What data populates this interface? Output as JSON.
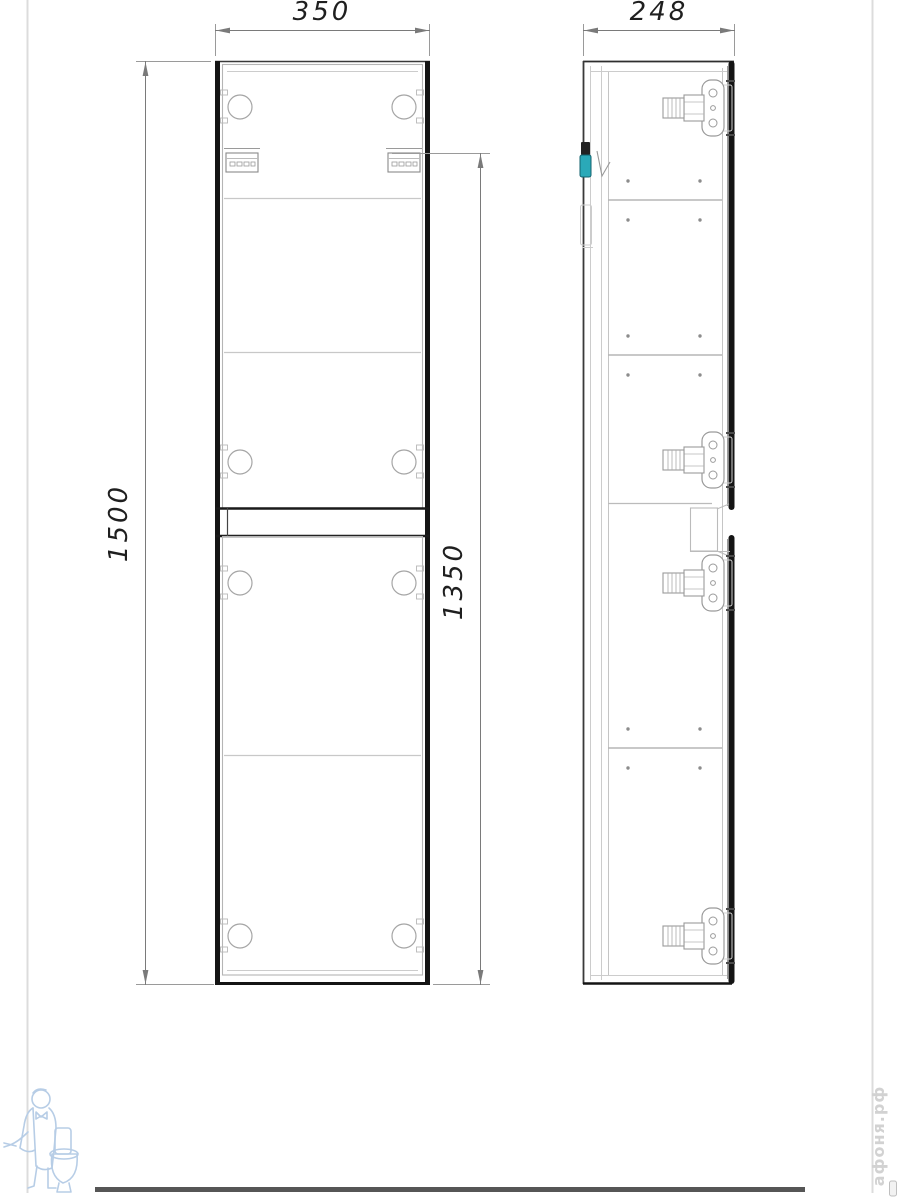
{
  "drawing": {
    "type": "technical-drawing",
    "subject": "tall two-door wall cabinet, front and side orthographic views",
    "dimensions": {
      "front_width": "350",
      "side_depth": "248",
      "overall_height": "1500",
      "hanging_height": "1350"
    },
    "views": {
      "front": {
        "doors": 2,
        "hinge_holes_per_door": 4,
        "shelf_lines": [
          "upper",
          "middle",
          "lower"
        ]
      },
      "side": {
        "hinges": 4,
        "shelves": 3,
        "wall_bracket_highlight": "teal"
      }
    },
    "colors": {
      "line_dark": "#161616",
      "line_medium": "#7a7a7a",
      "line_light": "#bdbdbd",
      "accent_teal": "#2aa9b8",
      "watermark_blue": "#b7cde6",
      "watermark_gray": "#d2d2d2",
      "frame_bar": "#555555"
    },
    "watermark": {
      "site_text": "афоня.рф"
    }
  }
}
